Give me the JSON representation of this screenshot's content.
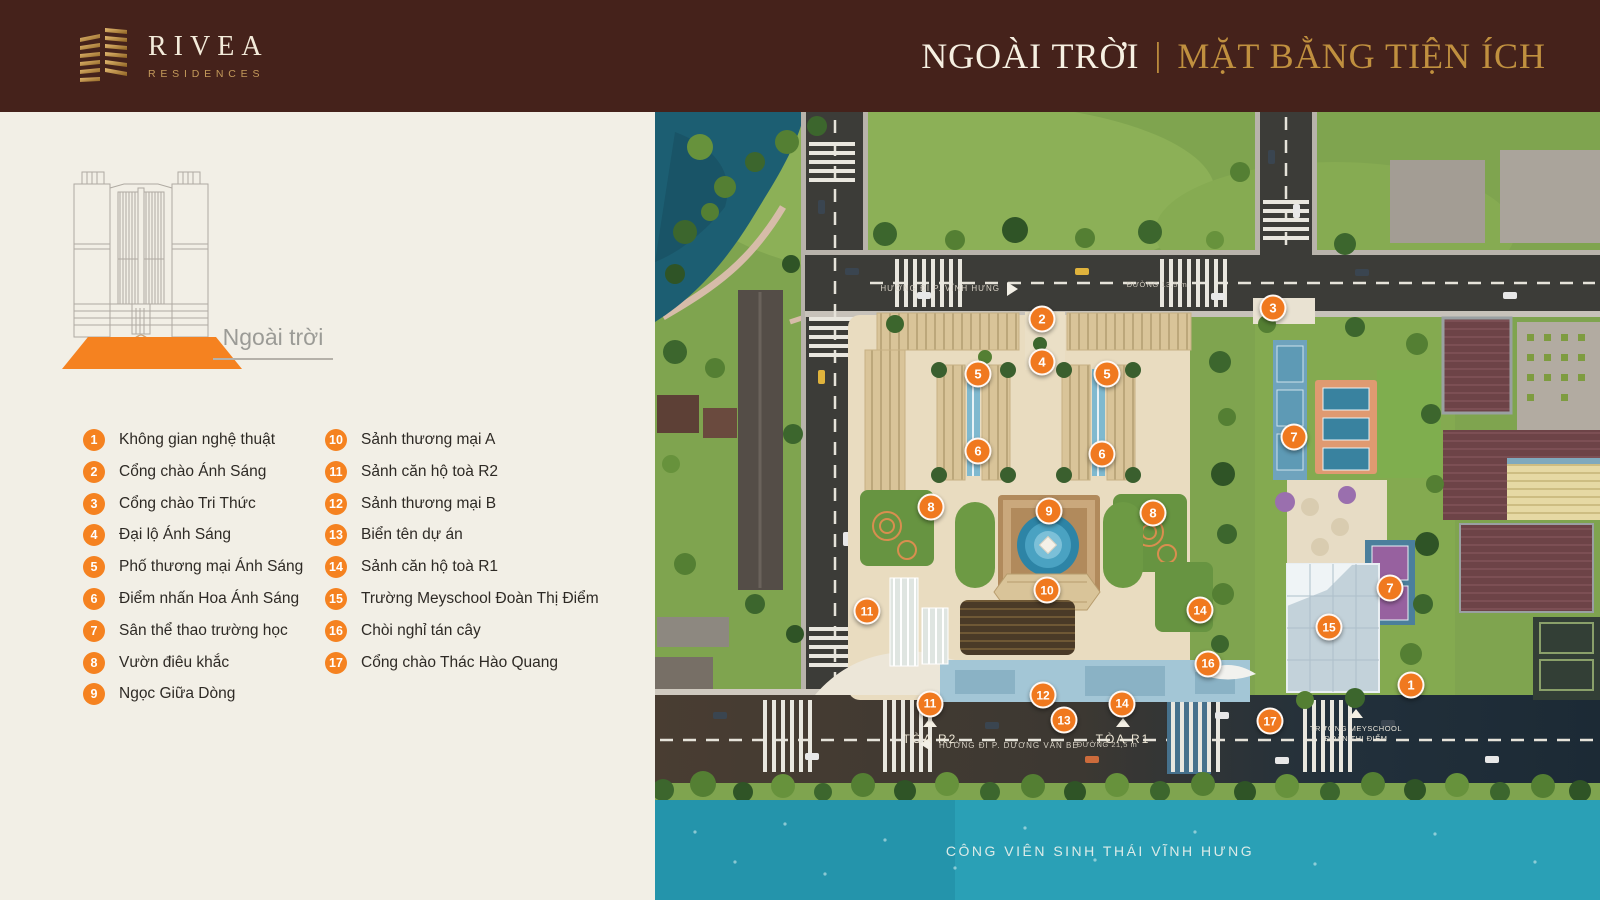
{
  "header": {
    "brand": {
      "name": "RIVEA",
      "sub": "RESIDENCES"
    },
    "title": {
      "left": "NGOÀI TRỜI",
      "separator": "|",
      "right": "MẶT BẰNG TIỆN ÍCH"
    }
  },
  "sidebar": {
    "level_label": "Ngoài trời",
    "legend": [
      {
        "n": "1",
        "label": "Không gian nghệ thuật"
      },
      {
        "n": "2",
        "label": "Cổng chào Ánh Sáng"
      },
      {
        "n": "3",
        "label": "Cổng chào Tri Thức"
      },
      {
        "n": "4",
        "label": "Đại lộ Ánh Sáng"
      },
      {
        "n": "5",
        "label": "Phố thương mại Ánh Sáng"
      },
      {
        "n": "6",
        "label": "Điểm nhấn Hoa Ánh Sáng"
      },
      {
        "n": "7",
        "label": "Sân thể thao trường học"
      },
      {
        "n": "8",
        "label": "Vườn điêu khắc"
      },
      {
        "n": "9",
        "label": "Ngọc Giữa Dòng"
      },
      {
        "n": "10",
        "label": "Sảnh thương mại A"
      },
      {
        "n": "11",
        "label": "Sảnh căn hộ toà R2"
      },
      {
        "n": "12",
        "label": "Sảnh thương mại B"
      },
      {
        "n": "13",
        "label": "Biển tên dự án"
      },
      {
        "n": "14",
        "label": "Sảnh căn hộ toà R1"
      },
      {
        "n": "15",
        "label": "Trường Meyschool Đoàn Thị Điểm"
      },
      {
        "n": "16",
        "label": "Chòi nghỉ tán cây"
      },
      {
        "n": "17",
        "label": "Cổng chào Thác Hào Quang"
      }
    ]
  },
  "map": {
    "markers": [
      {
        "n": "2",
        "x": 387,
        "y": 207
      },
      {
        "n": "3",
        "x": 618,
        "y": 196
      },
      {
        "n": "4",
        "x": 387,
        "y": 250
      },
      {
        "n": "5",
        "x": 323,
        "y": 262
      },
      {
        "n": "5",
        "x": 452,
        "y": 262
      },
      {
        "n": "6",
        "x": 323,
        "y": 339
      },
      {
        "n": "6",
        "x": 447,
        "y": 342
      },
      {
        "n": "7",
        "x": 639,
        "y": 325
      },
      {
        "n": "7",
        "x": 735,
        "y": 476
      },
      {
        "n": "8",
        "x": 276,
        "y": 395
      },
      {
        "n": "8",
        "x": 498,
        "y": 401
      },
      {
        "n": "9",
        "x": 394,
        "y": 399
      },
      {
        "n": "10",
        "x": 392,
        "y": 478
      },
      {
        "n": "11",
        "x": 212,
        "y": 499
      },
      {
        "n": "11",
        "x": 275,
        "y": 592
      },
      {
        "n": "12",
        "x": 388,
        "y": 583
      },
      {
        "n": "13",
        "x": 409,
        "y": 608
      },
      {
        "n": "14",
        "x": 545,
        "y": 498
      },
      {
        "n": "14",
        "x": 467,
        "y": 592
      },
      {
        "n": "15",
        "x": 674,
        "y": 515
      },
      {
        "n": "16",
        "x": 553,
        "y": 552
      },
      {
        "n": "17",
        "x": 615,
        "y": 609
      },
      {
        "n": "1",
        "x": 756,
        "y": 573
      }
    ],
    "labels": {
      "tower_r2": "TÒA R2",
      "tower_r1": "TÒA R1",
      "school_line1": "TRƯỜNG MEYSCHOOL",
      "school_line2": "ĐOÀN THỊ ĐIỂM",
      "road_top_direction": "HƯỚNG ĐI P. VĨNH HƯNG",
      "road_top_name": "ĐƯỜNG 13,5 m",
      "road_bottom_direction": "HƯỚNG ĐI P. DƯƠNG VĂN BÉ",
      "road_bottom_name": "ĐƯỜNG 21,5 m",
      "park": "CÔNG VIÊN SINH THÁI VĨNH HƯNG"
    }
  },
  "colors": {
    "accent_orange": "#F58220",
    "header_bg": "#45221B",
    "gold": "#C0903F",
    "panel_bg": "#F2EFE6",
    "water": "#2AA0B6"
  }
}
